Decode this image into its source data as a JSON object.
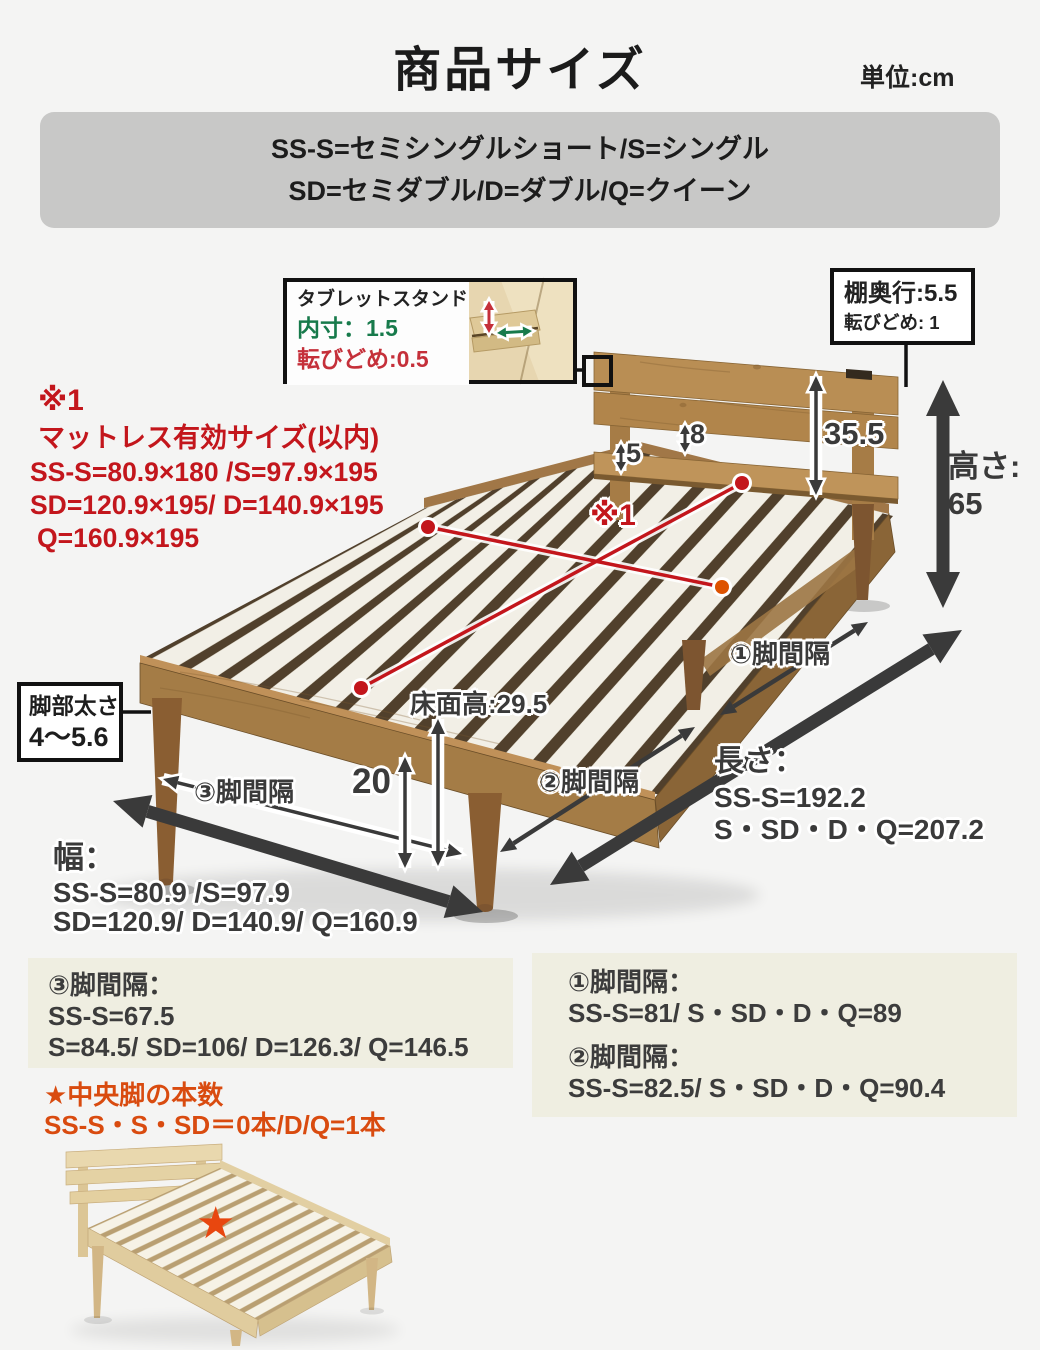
{
  "colors": {
    "accent_red": "#c3161c",
    "green": "#177a4b",
    "warn_orange": "#d94b0f",
    "box_cream": "#efeee1",
    "legend_gray": "#c8c8c7",
    "ink_dark": "#3a3a3a",
    "wood_main": "#a87e46",
    "wood_light": "#ead9b4"
  },
  "header": {
    "title": "商品サイズ",
    "unit": "単位:cm"
  },
  "legend": {
    "line1": "SS-S=セミシングルショート/S=シングル",
    "line2": "SD=セミダブル/D=ダブル/Q=クイーン"
  },
  "tablet_callout": {
    "title": "タブレットスタンド",
    "inner": "内寸：1.5",
    "stopper": "転びどめ:0.5"
  },
  "shelf_callout": {
    "depth": "棚奥行:5.5",
    "stopper": "転びどめ: 1"
  },
  "mattress_note": {
    "mark": "※1",
    "title": "マットレス有効サイズ(以内)",
    "line1": "SS-S=80.9×180 /S=97.9×195",
    "line2": "SD=120.9×195/ D=140.9×195",
    "line3": "Q=160.9×195"
  },
  "dims": {
    "gap5": "5",
    "gap8": "8",
    "headboard": "35.5",
    "height_label": "高さ:",
    "height": "65",
    "floor": "床面高:29.5",
    "leg": "20",
    "x1": "※1"
  },
  "leg_gaps": {
    "g1": "①脚間隔",
    "g2": "②脚間隔",
    "g3": "③脚間隔"
  },
  "leg_thickness": {
    "line1": "脚部太さ",
    "line2": "4〜5.6"
  },
  "length": {
    "label": "長さ：",
    "line1": "SS-S=192.2",
    "line2": "S・SD・D・Q=207.2"
  },
  "width": {
    "label": "幅：",
    "line1": "SS-S=80.9 /S=97.9",
    "line2": "SD=120.9/ D=140.9/ Q=160.9"
  },
  "info_left": {
    "title": "③脚間隔：",
    "line1": "SS-S=67.5",
    "line2": "S=84.5/ SD=106/ D=126.3/ Q=146.5"
  },
  "info_right": {
    "title1": "①脚間隔：",
    "line1": "SS-S=81/ S・SD・D・Q=89",
    "title2": "②脚間隔：",
    "line2": "SS-S=82.5/ S・SD・D・Q=90.4"
  },
  "center_leg_note": {
    "line1": "★中央脚の本数",
    "line2": "SS-S・S・SD＝0本/D/Q=1本"
  },
  "mini_bed": {
    "star": "★"
  }
}
